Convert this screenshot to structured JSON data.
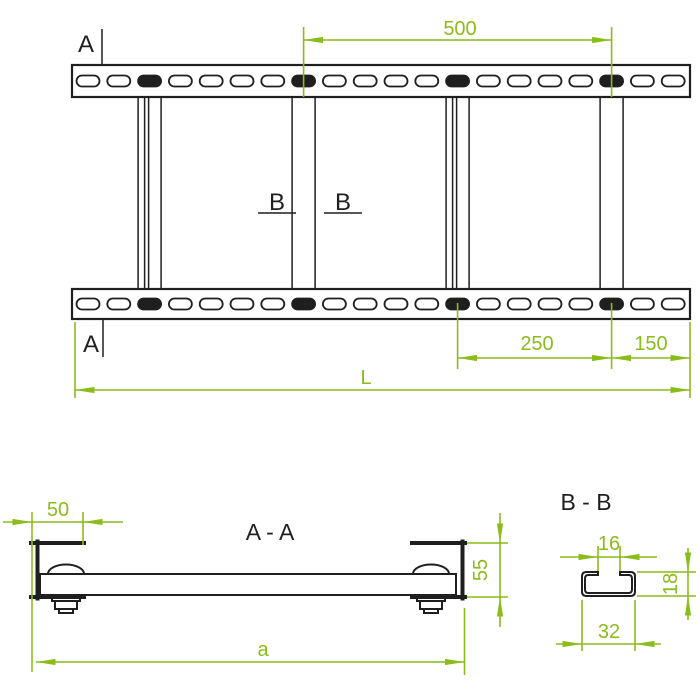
{
  "colors": {
    "dimension_green": "#8abc1a",
    "drawing_black": "#1f1f1f",
    "background": "#ffffff"
  },
  "top_view": {
    "marker_a_top": "A",
    "marker_a_bottom": "A",
    "marker_b_left": "B",
    "marker_b_right": "B",
    "dim_rung_spacing": "500",
    "dim_span": "250",
    "dim_end_offset": "150",
    "dim_total_length": "L"
  },
  "section_aa": {
    "title": "A - A",
    "dim_flange_width": "50",
    "dim_side_height": "55",
    "dim_overall_width": "a"
  },
  "section_bb": {
    "title": "B - B",
    "dim_slot_opening": "16",
    "dim_profile_height": "18",
    "dim_profile_width": "32"
  }
}
